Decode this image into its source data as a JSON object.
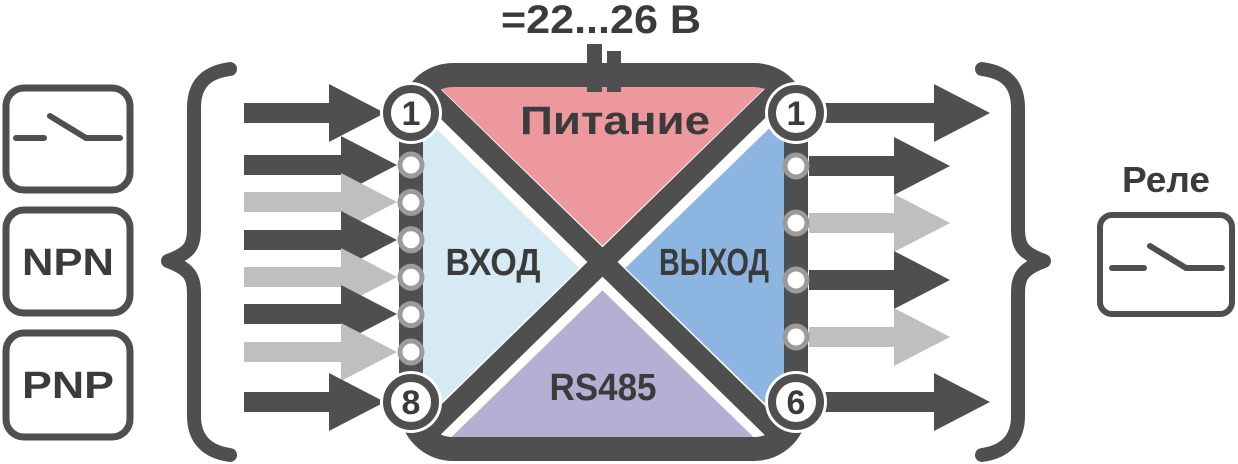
{
  "power": {
    "voltage_label": "=22...26 В"
  },
  "device": {
    "sections": {
      "power": "Питание",
      "input": "ВХОД",
      "output": "ВЫХОД",
      "bus": "RS485"
    },
    "left_terminals": {
      "first_number": "1",
      "last_number": "8",
      "middle_dot_count": 6
    },
    "right_terminals": {
      "first_number": "1",
      "last_number": "6",
      "middle_dot_count": 4
    }
  },
  "inputs": {
    "dry_contact_icon": "dry-contact-switch",
    "npn_label": "NPN",
    "pnp_label": "PNP",
    "arrow_styles": [
      "dark",
      "dark",
      "light",
      "dark",
      "light",
      "dark",
      "light",
      "dark"
    ]
  },
  "outputs": {
    "relay_label": "Реле",
    "relay_icon": "relay-contact-switch",
    "arrow_styles": [
      "dark",
      "dark",
      "light",
      "dark",
      "light",
      "dark"
    ]
  },
  "colors": {
    "dark": "#4F4F4F",
    "light_arrow": "#BFBFBF",
    "power_pink": "#EC989D",
    "input_light_blue": "#D6EAF3",
    "output_blue": "#8CB5E1",
    "bus_purple": "#B4AFD3",
    "dot_ring": "#9B9B9B",
    "label_text": "#3B3B3B"
  }
}
